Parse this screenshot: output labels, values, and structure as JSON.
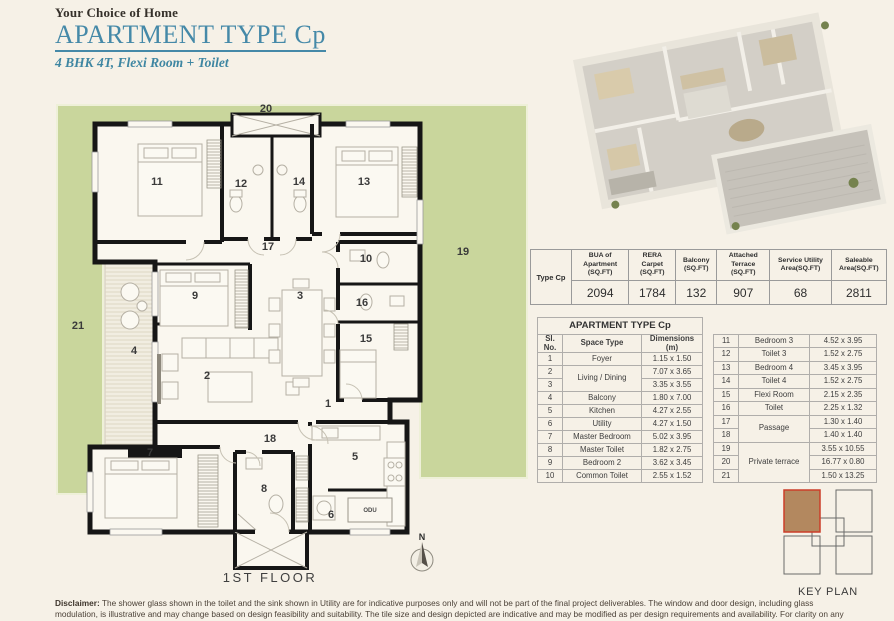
{
  "header": {
    "tagline": "Your Choice of Home",
    "title": "APARTMENT TYPE Cp",
    "subtitle": "4 BHK 4T, Flexi Room + Toilet"
  },
  "area_table": {
    "row_label": "Type Cp",
    "columns": [
      "BUA of Apartment (SQ.FT)",
      "RERA Carpet (SQ.FT)",
      "Balcony (SQ.FT)",
      "Attached Terrace (SQ.FT)",
      "Service Utility Area(SQ.FT)",
      "Saleable Area(SQ.FT)"
    ],
    "values": [
      "2094",
      "1784",
      "132",
      "907",
      "68",
      "2811"
    ]
  },
  "space_table": {
    "title": "APARTMENT TYPE Cp",
    "headers": {
      "sl": "Sl. No.",
      "space": "Space Type",
      "dim": "Dimensions (m)"
    },
    "left_rows": [
      {
        "sl": "1",
        "space": "Foyer",
        "dim": "1.15 x 1.50"
      },
      {
        "sl": "2",
        "space": "Living / Dining",
        "dim": "7.07 x 3.65"
      },
      {
        "sl": "3",
        "dim": "3.35 x 3.55"
      },
      {
        "sl": "4",
        "space": "Balcony",
        "dim": "1.80 x 7.00"
      },
      {
        "sl": "5",
        "space": "Kitchen",
        "dim": "4.27 x 2.55"
      },
      {
        "sl": "6",
        "space": "Utility",
        "dim": "4.27 x 1.50"
      },
      {
        "sl": "7",
        "space": "Master Bedroom",
        "dim": "5.02 x 3.95"
      },
      {
        "sl": "8",
        "space": "Master Toilet",
        "dim": "1.82 x 2.75"
      },
      {
        "sl": "9",
        "space": "Bedroom 2",
        "dim": "3.62 x 3.45"
      },
      {
        "sl": "10",
        "space": "Common Toilet",
        "dim": "2.55 x 1.52"
      }
    ],
    "right_rows": [
      {
        "sl": "11",
        "space": "Bedroom 3",
        "dim": "4.52 x 3.95"
      },
      {
        "sl": "12",
        "space": "Toilet 3",
        "dim": "1.52 x 2.75"
      },
      {
        "sl": "13",
        "space": "Bedroom 4",
        "dim": "3.45 x 3.95"
      },
      {
        "sl": "14",
        "space": "Toilet 4",
        "dim": "1.52 x 2.75"
      },
      {
        "sl": "15",
        "space": "Flexi Room",
        "dim": "2.15 x 2.35"
      },
      {
        "sl": "16",
        "space": "Toilet",
        "dim": "2.25 x 1.32"
      },
      {
        "sl": "17",
        "space": "Passage",
        "dim": "1.30 x 1.40"
      },
      {
        "sl": "18",
        "dim": "1.40 x 1.40"
      },
      {
        "sl": "19",
        "space": "Private terrace",
        "dim": "3.55 x 10.55"
      },
      {
        "sl": "20",
        "dim": "16.77 x 0.80"
      },
      {
        "sl": "21",
        "dim": "1.50 x 13.25"
      }
    ]
  },
  "floor_plan": {
    "label": "1ST FLOOR",
    "north": "N",
    "odu_label": "ODU",
    "rooms": [
      {
        "n": "20",
        "x": 216,
        "y": 20
      },
      {
        "n": "21",
        "x": 28,
        "y": 237
      },
      {
        "n": "19",
        "x": 413,
        "y": 163
      },
      {
        "n": "11",
        "x": 107,
        "y": 93
      },
      {
        "n": "12",
        "x": 191,
        "y": 95
      },
      {
        "n": "14",
        "x": 249,
        "y": 93
      },
      {
        "n": "13",
        "x": 314,
        "y": 93
      },
      {
        "n": "17",
        "x": 218,
        "y": 158
      },
      {
        "n": "10",
        "x": 316,
        "y": 170
      },
      {
        "n": "9",
        "x": 145,
        "y": 207
      },
      {
        "n": "3",
        "x": 250,
        "y": 207
      },
      {
        "n": "16",
        "x": 312,
        "y": 214
      },
      {
        "n": "4",
        "x": 84,
        "y": 262
      },
      {
        "n": "2",
        "x": 157,
        "y": 287
      },
      {
        "n": "15",
        "x": 316,
        "y": 250
      },
      {
        "n": "1",
        "x": 278,
        "y": 315
      },
      {
        "n": "18",
        "x": 220,
        "y": 350
      },
      {
        "n": "7",
        "x": 100,
        "y": 364
      },
      {
        "n": "8",
        "x": 214,
        "y": 400
      },
      {
        "n": "5",
        "x": 305,
        "y": 368
      },
      {
        "n": "6",
        "x": 281,
        "y": 426
      }
    ]
  },
  "key_plan": {
    "label": "KEY PLAN"
  },
  "disclaimer": {
    "label": "Disclaimer:",
    "text": " The shower glass shown in the toilet and the sink shown in Utility are for indicative purposes only and will not be part of the final project deliverables. The window and door design, including glass modulation, is illustrative and may change based on design feasibility and suitability. The tile size and design depicted are indicative and may be modified as per design requirements and availability. For clarity on any specifications, please refer to the AFS document."
  },
  "colors": {
    "accent_teal": "#4589a8",
    "terrace_green": "#c9d69c",
    "wall_black": "#161616",
    "keyplan_highlight": "#b3885f",
    "keyplan_outline": "#cc3d28",
    "page_background": "#f6f1e7"
  }
}
